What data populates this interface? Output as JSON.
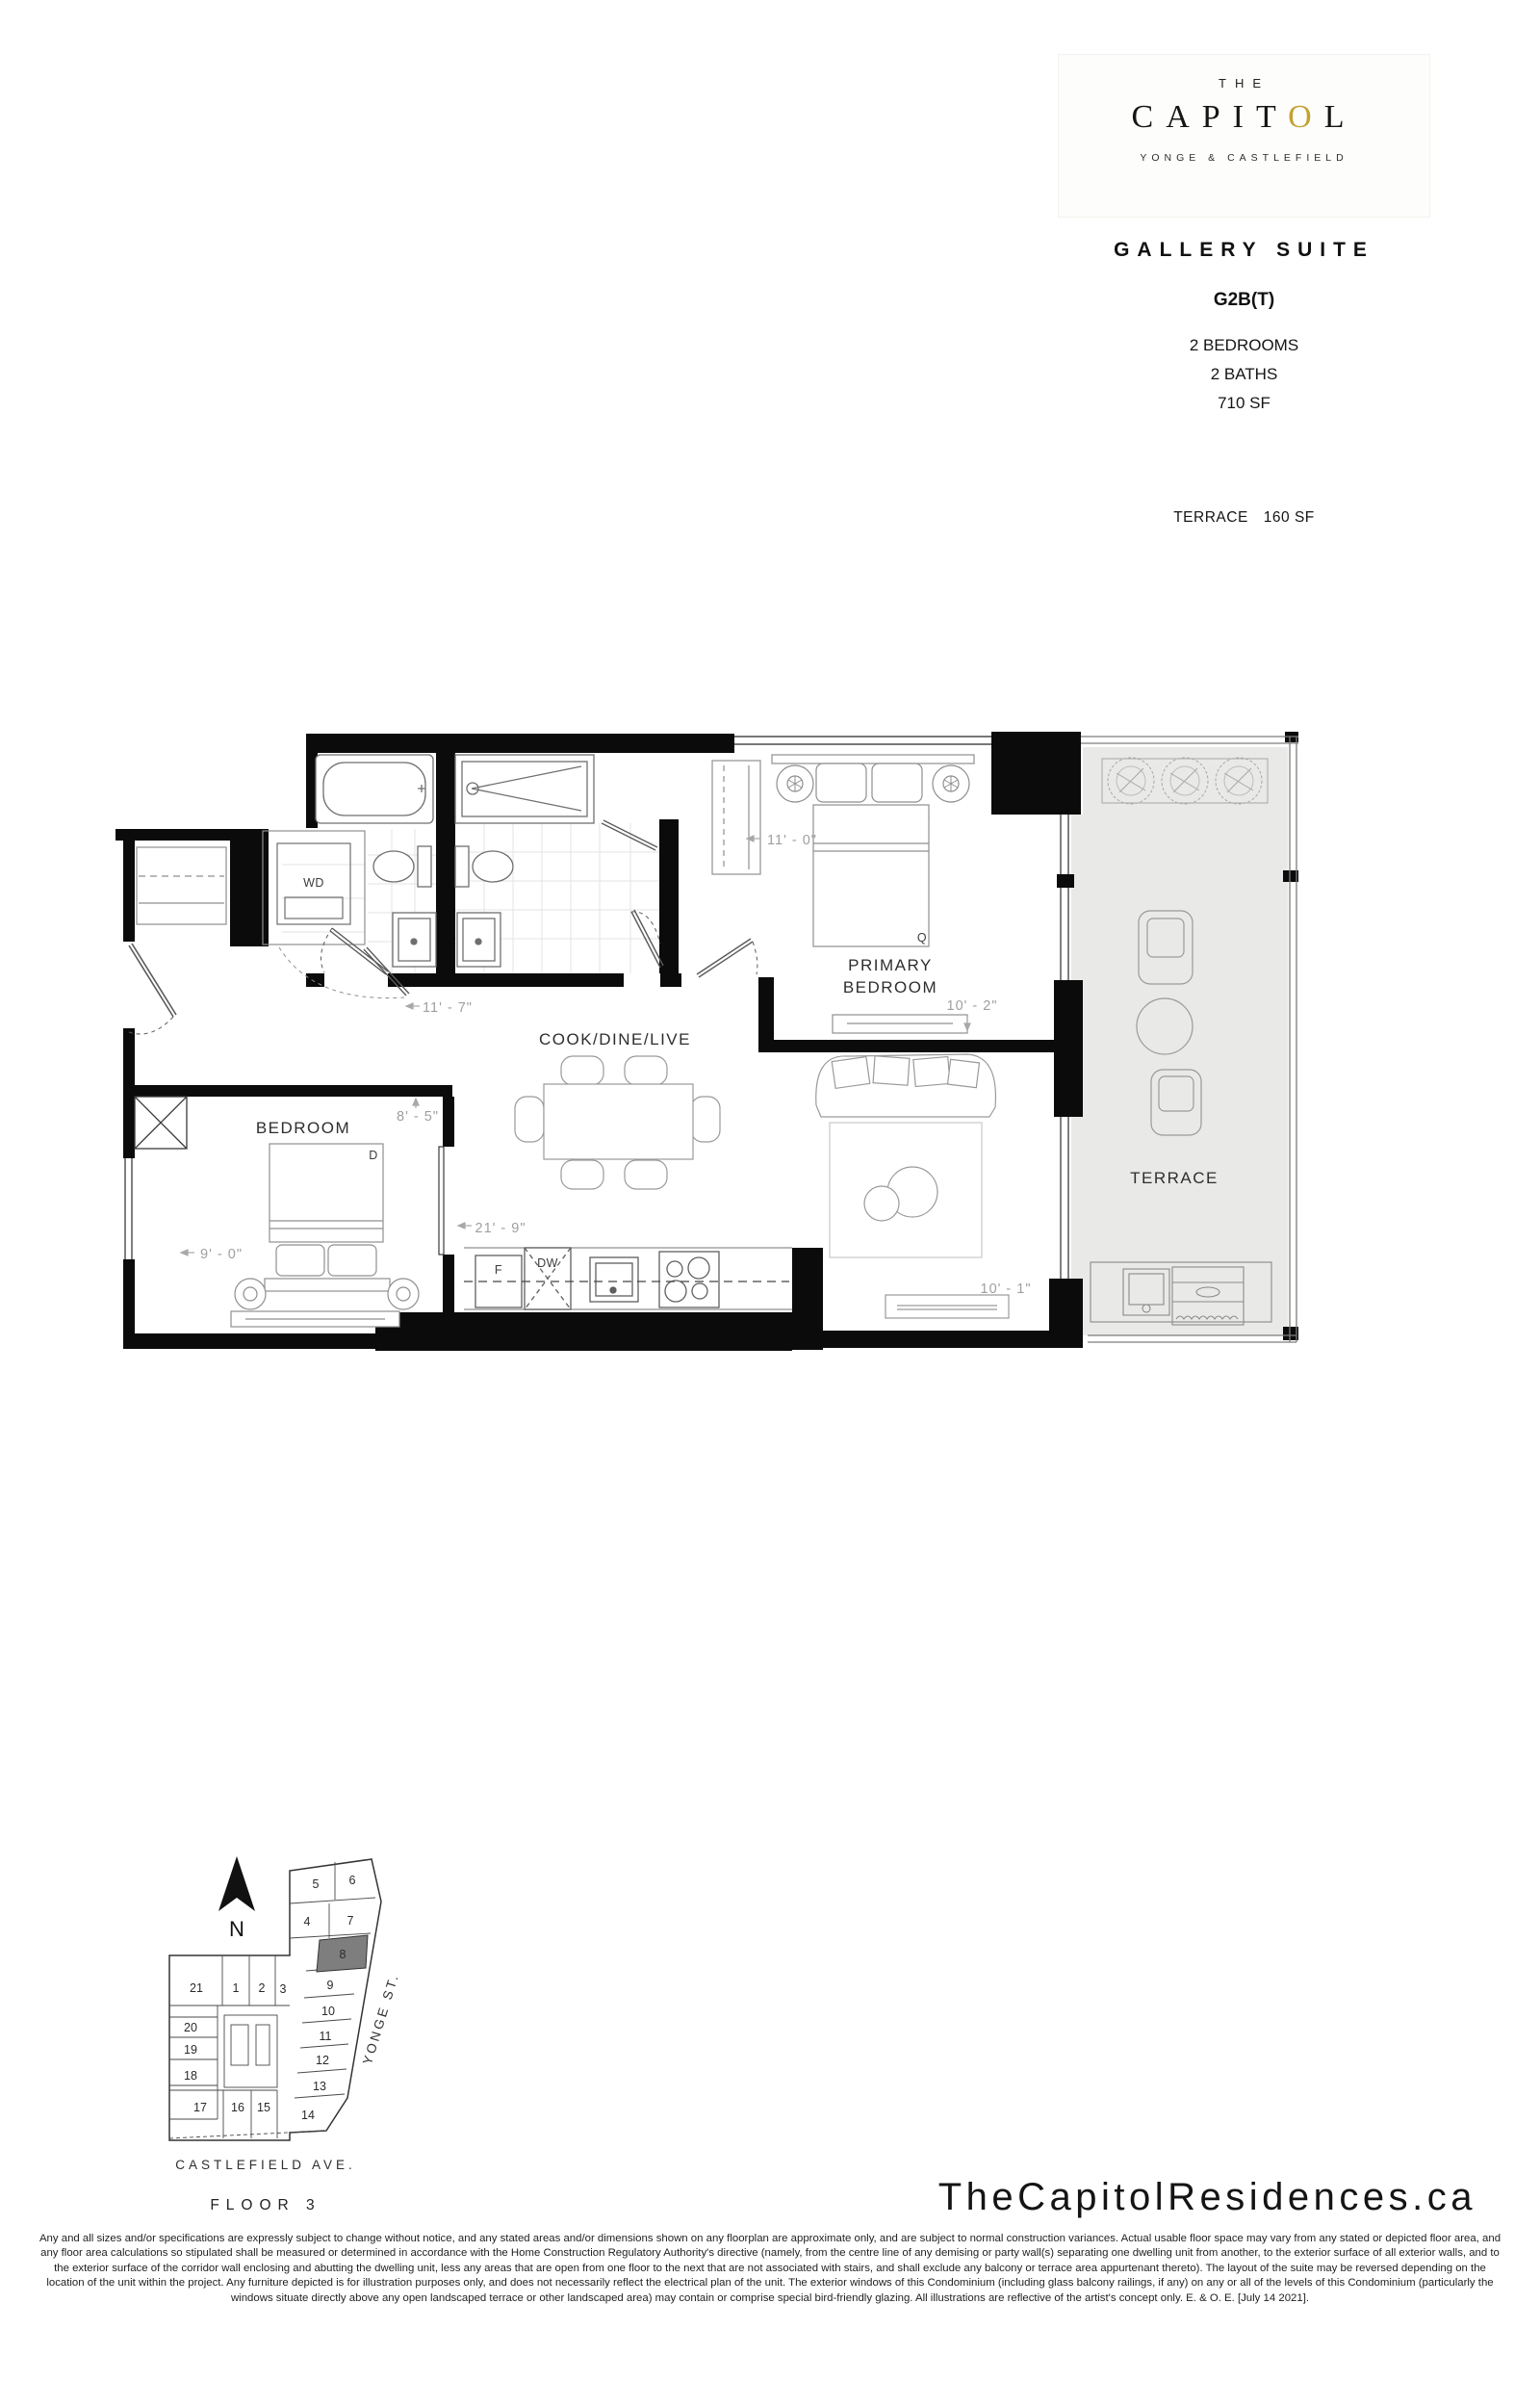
{
  "brand": {
    "the": "THE",
    "capitol_left": "CAPIT",
    "capitol_o": "O",
    "capitol_right": "L",
    "tagline": "YONGE & CASTLEFIELD"
  },
  "suite": {
    "collection": "GALLERY SUITE",
    "model": "G2B(T)",
    "bedrooms": "2 BEDROOMS",
    "baths": "2 BATHS",
    "area": "710 SF",
    "terrace_label": "TERRACE",
    "terrace_area": "160 SF"
  },
  "plan": {
    "rooms": {
      "cook_dine_live": "COOK/DINE/LIVE",
      "primary_line1": "PRIMARY",
      "primary_line2": "BEDROOM",
      "bedroom": "BEDROOM",
      "terrace": "TERRACE"
    },
    "fixtures": {
      "washer_dryer": "WD",
      "fridge": "F",
      "dishwasher": "DW",
      "queen_bed": "Q",
      "double_bed": "D"
    },
    "dimensions": {
      "bath_hall": "11' - 7\"",
      "primary_width": "11' - 0\"",
      "primary_depth": "10' - 2\"",
      "bedroom_width": "8' - 5\"",
      "bedroom_depth": "9' - 0\"",
      "main_length": "21' - 9\"",
      "living_width": "10' - 1\""
    }
  },
  "keyplan": {
    "north": "N",
    "street_side": "YONGE ST.",
    "street_bottom": "CASTLEFIELD AVE.",
    "floor": "FLOOR 3",
    "highlighted_unit": "8",
    "units": [
      "5",
      "6",
      "4",
      "7",
      "8",
      "9",
      "10",
      "11",
      "12",
      "13",
      "14",
      "21",
      "1",
      "2",
      "3",
      "20",
      "19",
      "18",
      "17",
      "16",
      "15"
    ]
  },
  "footer": {
    "website": "TheCapitolResidences.ca",
    "disclaimer": "Any and all sizes and/or specifications are expressly subject to change without notice, and any stated areas and/or dimensions shown on any floorplan are approximate only, and are subject to normal construction variances. Actual usable floor space may vary from any stated or depicted floor area, and any floor area calculations so stipulated shall be measured or determined in accordance with the Home Construction Regulatory Authority's directive (namely, from the centre line of any demising or party wall(s) separating one dwelling unit from another, to the exterior surface of all exterior walls, and to the exterior surface of the corridor wall enclosing and abutting the dwelling unit, less any areas that are open from one floor to the next that are not associated with stairs, and shall exclude any balcony or terrace area appurtenant thereto). The layout of the suite may be reversed depending on the location of the unit within the project. Any furniture depicted is for illustration purposes only, and does not necessarily reflect the electrical plan of the unit. The exterior windows of this Condominium (including glass balcony railings, if any) on any or all of the levels of this Condominium (particularly the windows situate directly above any open landscaped terrace or other landscaped area) may contain or comprise special bird-friendly glazing. All illustrations are reflective of the artist's concept only. E. & O. E. [July 14 2021]."
  },
  "colors": {
    "gold": "#C3A233",
    "terrace_floor": "#e9e9e7",
    "highlight_gray": "#7e7e7e",
    "wall": "#0b0b0b"
  }
}
